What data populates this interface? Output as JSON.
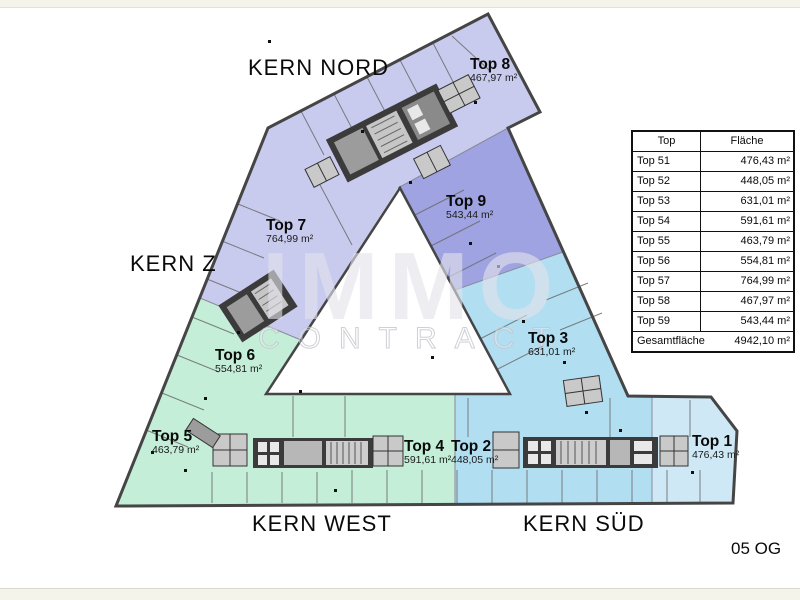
{
  "floor": {
    "label": "05 OG"
  },
  "watermark": {
    "line1": "IMMO",
    "line2": "CONTRACT"
  },
  "kern_labels": {
    "nord": "KERN NORD",
    "z": "KERN Z",
    "west": "KERN WEST",
    "sued": "KERN SÜD"
  },
  "units": [
    {
      "name": "Top 1",
      "area": "476,43 m²"
    },
    {
      "name": "Top 2",
      "area": "448,05 m²"
    },
    {
      "name": "Top 3",
      "area": "631,01 m²"
    },
    {
      "name": "Top 4",
      "area": "591,61 m²"
    },
    {
      "name": "Top 5",
      "area": "463,79 m²"
    },
    {
      "name": "Top 6",
      "area": "554,81 m²"
    },
    {
      "name": "Top 7",
      "area": "764,99 m²"
    },
    {
      "name": "Top 8",
      "area": "467,97 m²"
    },
    {
      "name": "Top 9",
      "area": "543,44 m²"
    }
  ],
  "table": {
    "headers": [
      "Top",
      "Fläche"
    ],
    "rows": [
      [
        "Top 51",
        "476,43 m²"
      ],
      [
        "Top 52",
        "448,05 m²"
      ],
      [
        "Top 53",
        "631,01 m²"
      ],
      [
        "Top 54",
        "591,61 m²"
      ],
      [
        "Top 55",
        "463,79 m²"
      ],
      [
        "Top 56",
        "554,81 m²"
      ],
      [
        "Top 57",
        "764,99 m²"
      ],
      [
        "Top 58",
        "467,97 m²"
      ],
      [
        "Top 59",
        "543,44 m²"
      ]
    ],
    "footer": {
      "label": "Gesamtfläche",
      "value": "4942,10 m²"
    }
  },
  "colors": {
    "lavender": "#c9cbee",
    "purple": "#9fa3e1",
    "green": "#c4eed8",
    "blue": "#b2def2",
    "light_blue": "#cfe8f6",
    "outline": "#454545",
    "core": "#3b3b3b"
  }
}
